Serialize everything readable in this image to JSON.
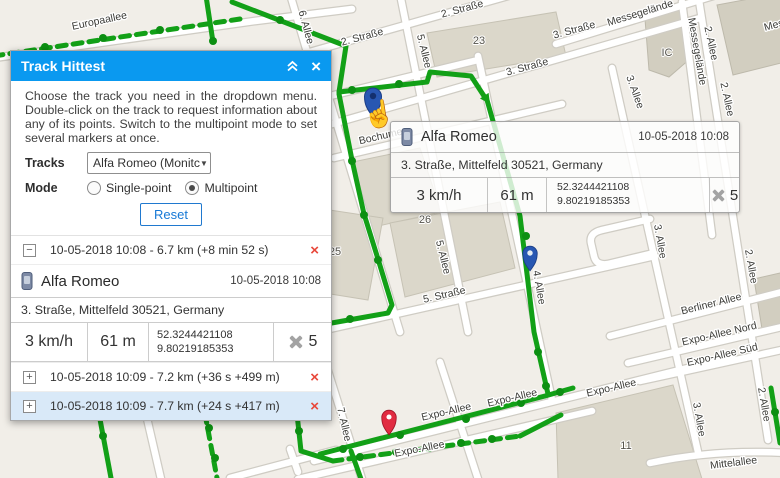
{
  "colors": {
    "header_blue": "#0a99f0",
    "track_green": "#12a017",
    "row_highlight": "#d9e9f8",
    "delete_red": "#e8473a",
    "pin_blue": "#2857b2",
    "pin_red": "#e12b41",
    "link_blue": "#1779d6"
  },
  "panel": {
    "title": "Track Hittest",
    "close_glyph": "×",
    "description": "Choose the track you need in the dropdown menu. Double-click on the track to request information about any of its points. Switch to the multipoint mode to set several markers at once.",
    "tracks_label": "Tracks",
    "track_select_value": "Alfa Romeo (Monitc",
    "select_caret": "▼",
    "mode_label": "Mode",
    "mode": {
      "single_label": "Single-point",
      "multi_label": "Multipoint",
      "selected": "Multipoint"
    },
    "reset_label": "Reset",
    "items": [
      {
        "toggle": "−",
        "summary": "10-05-2018 10:08 - 6.7 km (+8 min 52 s)",
        "close": "×",
        "expanded": true
      },
      {
        "toggle": "+",
        "summary": "10-05-2018 10:09 - 7.2 km (+36 s +499 m)",
        "close": "×",
        "expanded": false
      },
      {
        "toggle": "+",
        "summary": "10-05-2018 10:09 - 7.7 km (+24 s +417 m)",
        "close": "×",
        "expanded": false,
        "selected": true
      }
    ],
    "detail": {
      "unit": "Alfa Romeo",
      "time": "10-05-2018 10:08",
      "address": "3. Straße, Mittelfeld 30521, Germany",
      "speed": "3 km/h",
      "altitude": "61 m",
      "lat": "52.3244421108",
      "lon": "9.80219185353",
      "satellites": "5"
    }
  },
  "tooltip": {
    "unit": "Alfa Romeo",
    "time": "10-05-2018 10:08",
    "address": "3. Straße, Mittelfeld 30521, Germany",
    "speed": "3 km/h",
    "altitude": "61 m",
    "lat": "52.3244421108",
    "lon": "9.80219185353",
    "satellites": "5"
  },
  "map": {
    "labels": [
      {
        "t": "Europaallee",
        "x": 100,
        "y": 24,
        "r": -12
      },
      {
        "t": "6. Allee",
        "x": 303,
        "y": 28,
        "r": 75
      },
      {
        "t": "2. Straße",
        "x": 363,
        "y": 40,
        "r": -15
      },
      {
        "t": "2. Straße",
        "x": 463,
        "y": 12,
        "r": -15
      },
      {
        "t": "23",
        "x": 479,
        "y": 44,
        "r": 0,
        "cls": "bn"
      },
      {
        "t": "3. Straße",
        "x": 528,
        "y": 70,
        "r": -15
      },
      {
        "t": "3. Straße",
        "x": 575,
        "y": 33,
        "r": -15
      },
      {
        "t": "5. Allee",
        "x": 421,
        "y": 52,
        "r": 76
      },
      {
        "t": "Messegelände",
        "x": 641,
        "y": 16,
        "r": -17
      },
      {
        "t": "Messegelände",
        "x": 694,
        "y": 52,
        "r": 80
      },
      {
        "t": "Messegelände",
        "x": 798,
        "y": 22,
        "r": -15
      },
      {
        "t": "IC",
        "x": 667,
        "y": 56,
        "r": 0,
        "cls": "bn"
      },
      {
        "t": "2. Allee",
        "x": 708,
        "y": 44,
        "r": 78
      },
      {
        "t": "2. Allee",
        "x": 724,
        "y": 100,
        "r": 78
      },
      {
        "t": "Bochumer",
        "x": 383,
        "y": 139,
        "r": -13
      },
      {
        "t": "25",
        "x": 335,
        "y": 255,
        "r": 0,
        "cls": "bn"
      },
      {
        "t": "26",
        "x": 425,
        "y": 223,
        "r": 0,
        "cls": "bn"
      },
      {
        "t": "5. Straße",
        "x": 445,
        "y": 298,
        "r": -13
      },
      {
        "t": "5. Allee",
        "x": 440,
        "y": 258,
        "r": 76
      },
      {
        "t": "4. Allee",
        "x": 536,
        "y": 288,
        "r": 80
      },
      {
        "t": "3. Allee",
        "x": 632,
        "y": 93,
        "r": 70
      },
      {
        "t": "3. Allee",
        "x": 657,
        "y": 242,
        "r": 80
      },
      {
        "t": "2. Allee",
        "x": 748,
        "y": 267,
        "r": 80
      },
      {
        "t": "Berliner Allee",
        "x": 712,
        "y": 307,
        "r": -14
      },
      {
        "t": "Expo-Allee Nord",
        "x": 720,
        "y": 337,
        "r": -13
      },
      {
        "t": "Expo-Allee Süd",
        "x": 723,
        "y": 358,
        "r": -13
      },
      {
        "t": "Expo-Allee",
        "x": 447,
        "y": 415,
        "r": -13
      },
      {
        "t": "Expo-Allee",
        "x": 513,
        "y": 401,
        "r": -13
      },
      {
        "t": "Expo-Allee",
        "x": 612,
        "y": 391,
        "r": -13
      },
      {
        "t": "Expo-Allee",
        "x": 420,
        "y": 452,
        "r": -11
      },
      {
        "t": "7. Allee",
        "x": 341,
        "y": 425,
        "r": 77
      },
      {
        "t": "3. Allee",
        "x": 696,
        "y": 420,
        "r": 80
      },
      {
        "t": "2. Allee",
        "x": 761,
        "y": 405,
        "r": 80
      },
      {
        "t": "Mittelallee",
        "x": 734,
        "y": 466,
        "r": -7
      },
      {
        "t": "11",
        "x": 626,
        "y": 449,
        "r": 0,
        "cls": "bn"
      }
    ]
  }
}
